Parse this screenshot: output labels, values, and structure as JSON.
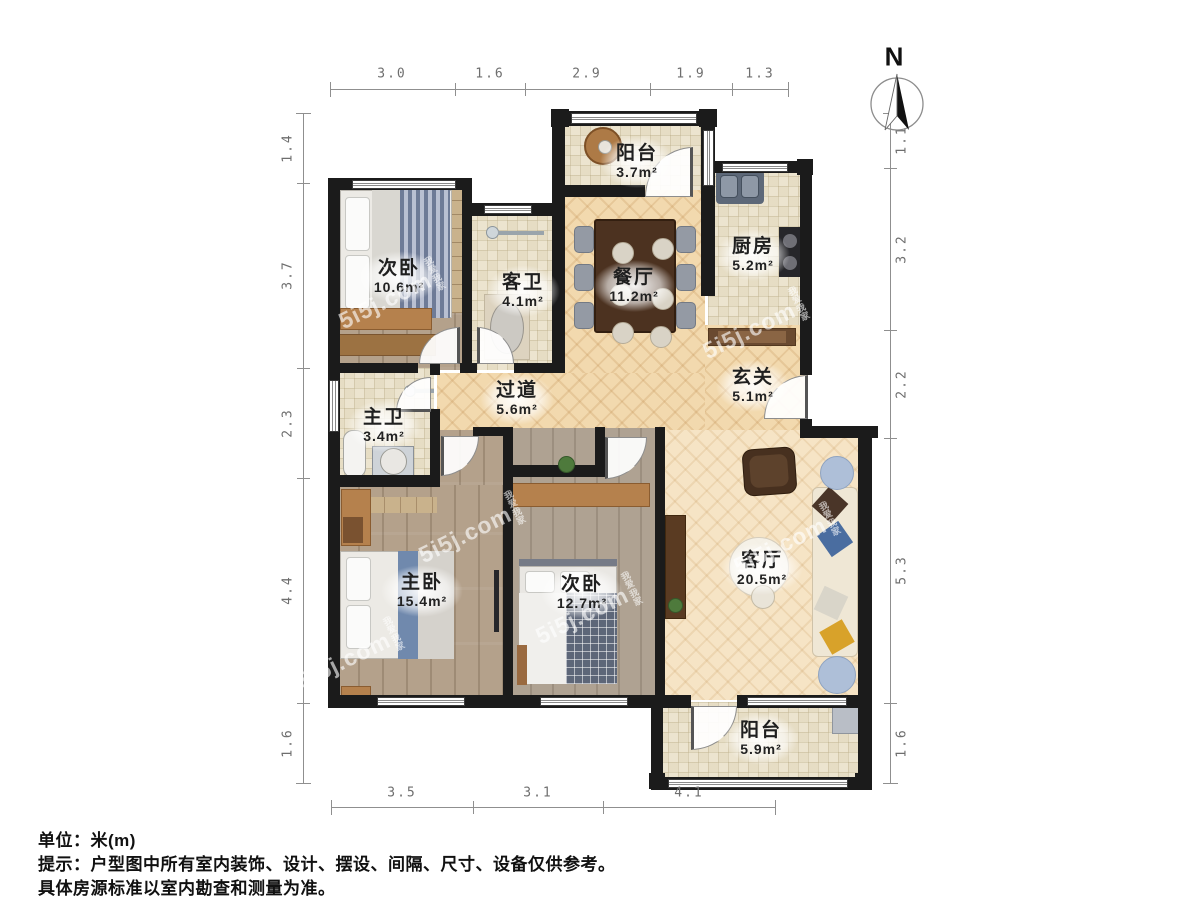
{
  "north": {
    "label": "N"
  },
  "watermark": {
    "text": "5i5j.com",
    "brand": "我爱我家"
  },
  "rooms": [
    {
      "name": "阳台",
      "area": "3.7m²"
    },
    {
      "name": "次卧",
      "area": "10.6m²"
    },
    {
      "name": "客卫",
      "area": "4.1m²"
    },
    {
      "name": "餐厅",
      "area": "11.2m²"
    },
    {
      "name": "厨房",
      "area": "5.2m²"
    },
    {
      "name": "玄关",
      "area": "5.1m²"
    },
    {
      "name": "过道",
      "area": "5.6m²"
    },
    {
      "name": "主卫",
      "area": "3.4m²"
    },
    {
      "name": "主卧",
      "area": "15.4m²"
    },
    {
      "name": "次卧",
      "area": "12.7m²"
    },
    {
      "name": "客厅",
      "area": "20.5m²"
    },
    {
      "name": "阳台",
      "area": "5.9m²"
    }
  ],
  "dimensions": {
    "top": [
      "3.0",
      "1.6",
      "2.9",
      "1.9",
      "1.3"
    ],
    "bottom": [
      "3.5",
      "3.1",
      "4.1"
    ],
    "left": [
      "1.4",
      "3.7",
      "2.3",
      "4.4",
      "1.6"
    ],
    "right": [
      "1.1",
      "3.2",
      "2.2",
      "5.3",
      "1.6"
    ]
  },
  "footer": {
    "unit_line": "单位：米(m)",
    "tip_line1": "提示：户型图中所有室内装饰、设计、摆设、间隔、尺寸、设备仅供参考。",
    "tip_line2": "具体房源标准以室内勘查和测量为准。"
  }
}
